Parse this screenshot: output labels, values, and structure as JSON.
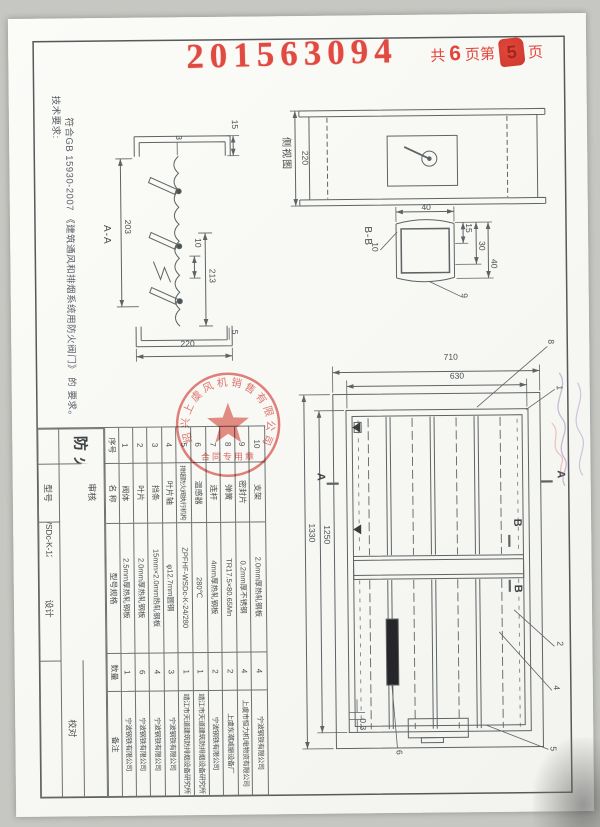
{
  "page": {
    "serial_stamp": "201563094",
    "page_stamp": {
      "prefix": "共",
      "total": "6",
      "mid": "页第",
      "num": "5",
      "suffix": "页"
    }
  },
  "tech_requirements": {
    "heading": "技术要求:",
    "body": "符合GB 15930-2007 《建筑通风和排烟系统用防火阀门》 的 要求。"
  },
  "views": {
    "side_view": {
      "label": "侧视图",
      "dim_depth": "220"
    },
    "section_aa": {
      "label": "A-A",
      "dim_width": "220",
      "dim_203": "203",
      "dim_213": "213",
      "dim_10": "10",
      "dim_15": "15",
      "dim_5": "5",
      "dim_3": "3"
    },
    "section_bb": {
      "label": "B-B",
      "dim_40_left": "40",
      "dim_15": "15",
      "dim_30": "30",
      "dim_40_right": "40",
      "leader_10": "10",
      "leader_9": "9"
    },
    "front_view": {
      "dim_710": "710",
      "dim_630": "630",
      "dim_1250": "1250",
      "dim_1330": "1330",
      "dim_gap": "0.3",
      "leader_1": "1",
      "leader_2": "2",
      "leader_4": "4",
      "leader_5": "5",
      "leader_6": "6",
      "leader_8": "8",
      "marker_a": "A",
      "marker_b": "B"
    }
  },
  "parts_table": {
    "headers": {
      "no": "序号",
      "name": "名  称",
      "spec": "型号规格",
      "qty": "数量",
      "remark": "备注"
    },
    "rows": [
      {
        "no": "10",
        "name": "支架",
        "spec": "2.0mm厚热轧钢板",
        "qty": "4",
        "remark": "宁波钢铁有限公司"
      },
      {
        "no": "9",
        "name": "密封片",
        "spec": "0.2mm厚不锈钢",
        "qty": "4",
        "remark": "上虞市恒力机电物资有限公司"
      },
      {
        "no": "8",
        "name": "弹簧",
        "spec": "TR17.5×80.65Mn",
        "qty": "2",
        "remark": "上虞东潮减振设备厂"
      },
      {
        "no": "7",
        "name": "连杆",
        "spec": "4mm厚热轧钢板",
        "qty": "2",
        "remark": "宁波钢铁有限公司"
      },
      {
        "no": "6",
        "name": "温感器",
        "spec": "280℃",
        "qty": "1",
        "remark": "靖江市天道建筑防排烟设备研究所"
      },
      {
        "no": "5",
        "name": "排烟防火阀执行机构",
        "spec": "ZPFHF-WSDc-K-24/280",
        "qty": "1",
        "remark": "靖江市天道建筑防排烟设备研究所"
      },
      {
        "no": "4",
        "name": "叶片轴",
        "spec": "φ12.7mm圆钢",
        "qty": "3",
        "remark": "宁波钢铁有限公司"
      },
      {
        "no": "3",
        "name": "挡条",
        "spec": "15mm×2.0mm热轧钢板",
        "qty": "4",
        "remark": "宁波钢铁有限公司"
      },
      {
        "no": "2",
        "name": "叶片",
        "spec": "2.0mm厚热轧钢板",
        "qty": "6",
        "remark": "宁波钢铁有限公司"
      },
      {
        "no": "1",
        "name": "阀体",
        "spec": "2.5mm厚热轧钢板",
        "qty": "1",
        "remark": "宁波钢铁有限公司"
      }
    ]
  },
  "title_block": {
    "row1_label": "审核",
    "row2_label": "校对",
    "row3_label": "设计",
    "model_label": "型号",
    "date_label": "日期",
    "model_value": "PFHF WSDc-K-1250×630",
    "product_name": "排烟防火阀",
    "company": "绍兴上虞风机销售有限公司"
  },
  "seal": {
    "ring_text": "绍兴上虞风机销售有限公司",
    "subtitle": "合同专用章"
  }
}
